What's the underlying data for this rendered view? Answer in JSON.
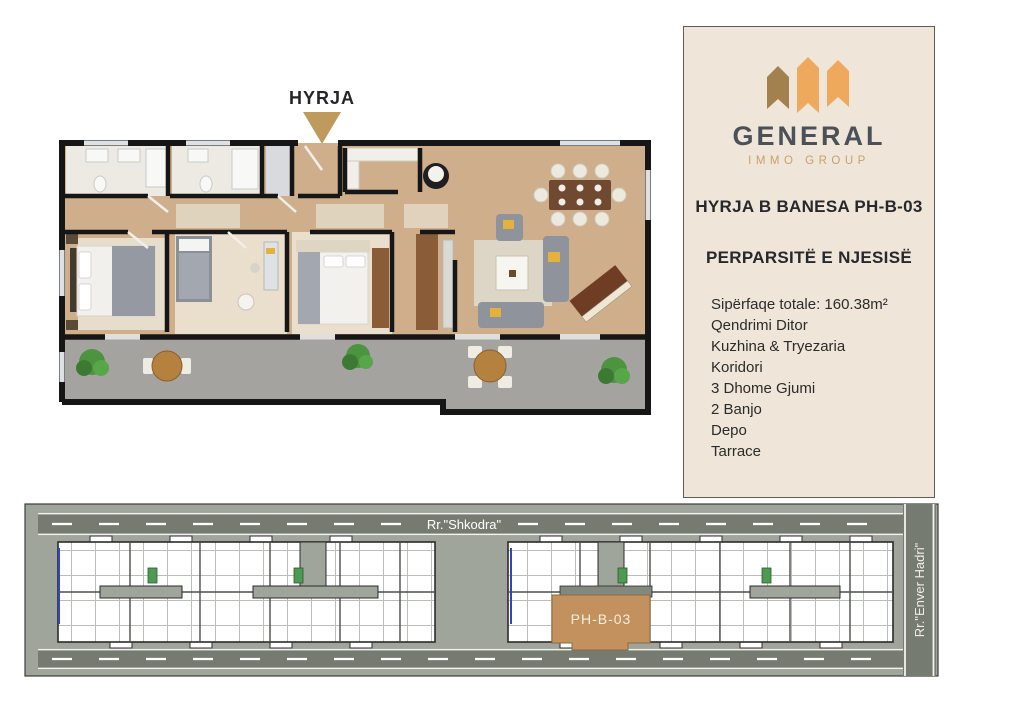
{
  "entrance": {
    "label": "HYRJA",
    "arrow_color": "#bf9a5d"
  },
  "panel": {
    "background": "#efe5d8",
    "logo": {
      "brand": "GENERAL",
      "subbrand": "IMMO GROUP",
      "orange": "#efa95c",
      "brown": "#a2814e",
      "brand_color": "#4b5158",
      "subbrand_color": "#c6a26c"
    },
    "title": "HYRJA B BANESA PH-B-03",
    "subtitle": "PERPARSITË E NJESISË",
    "features": [
      "Sipërfaqe totale: 160.38m²",
      "Qendrimi Ditor",
      "Kuzhina & Tryezaria",
      "Koridori",
      "3 Dhome Gjumi",
      "2 Banjo",
      "Depo",
      "Tarrace"
    ]
  },
  "siteplan": {
    "street_top": "Rr.\"Shkodra\"",
    "street_right": "Rr.\"Enver Hadri\"",
    "unit": {
      "label": "PH-B-03",
      "highlight_color": "#c2915d"
    },
    "road_color": "#767b72",
    "ground_color": "#9fa59a",
    "core_color": "#4e9a52"
  },
  "floorplan_colors": {
    "walls": "#161616",
    "wood_floor": "#cfae8c",
    "bath_floor": "#eceae3",
    "carpet_floor": "#eadfcd",
    "terrace": "#a5a3a0",
    "sofa": "#8e939c",
    "accent_pillow": "#e5b13d",
    "plant": "#4c9440",
    "wood_table": "#b5813f"
  }
}
